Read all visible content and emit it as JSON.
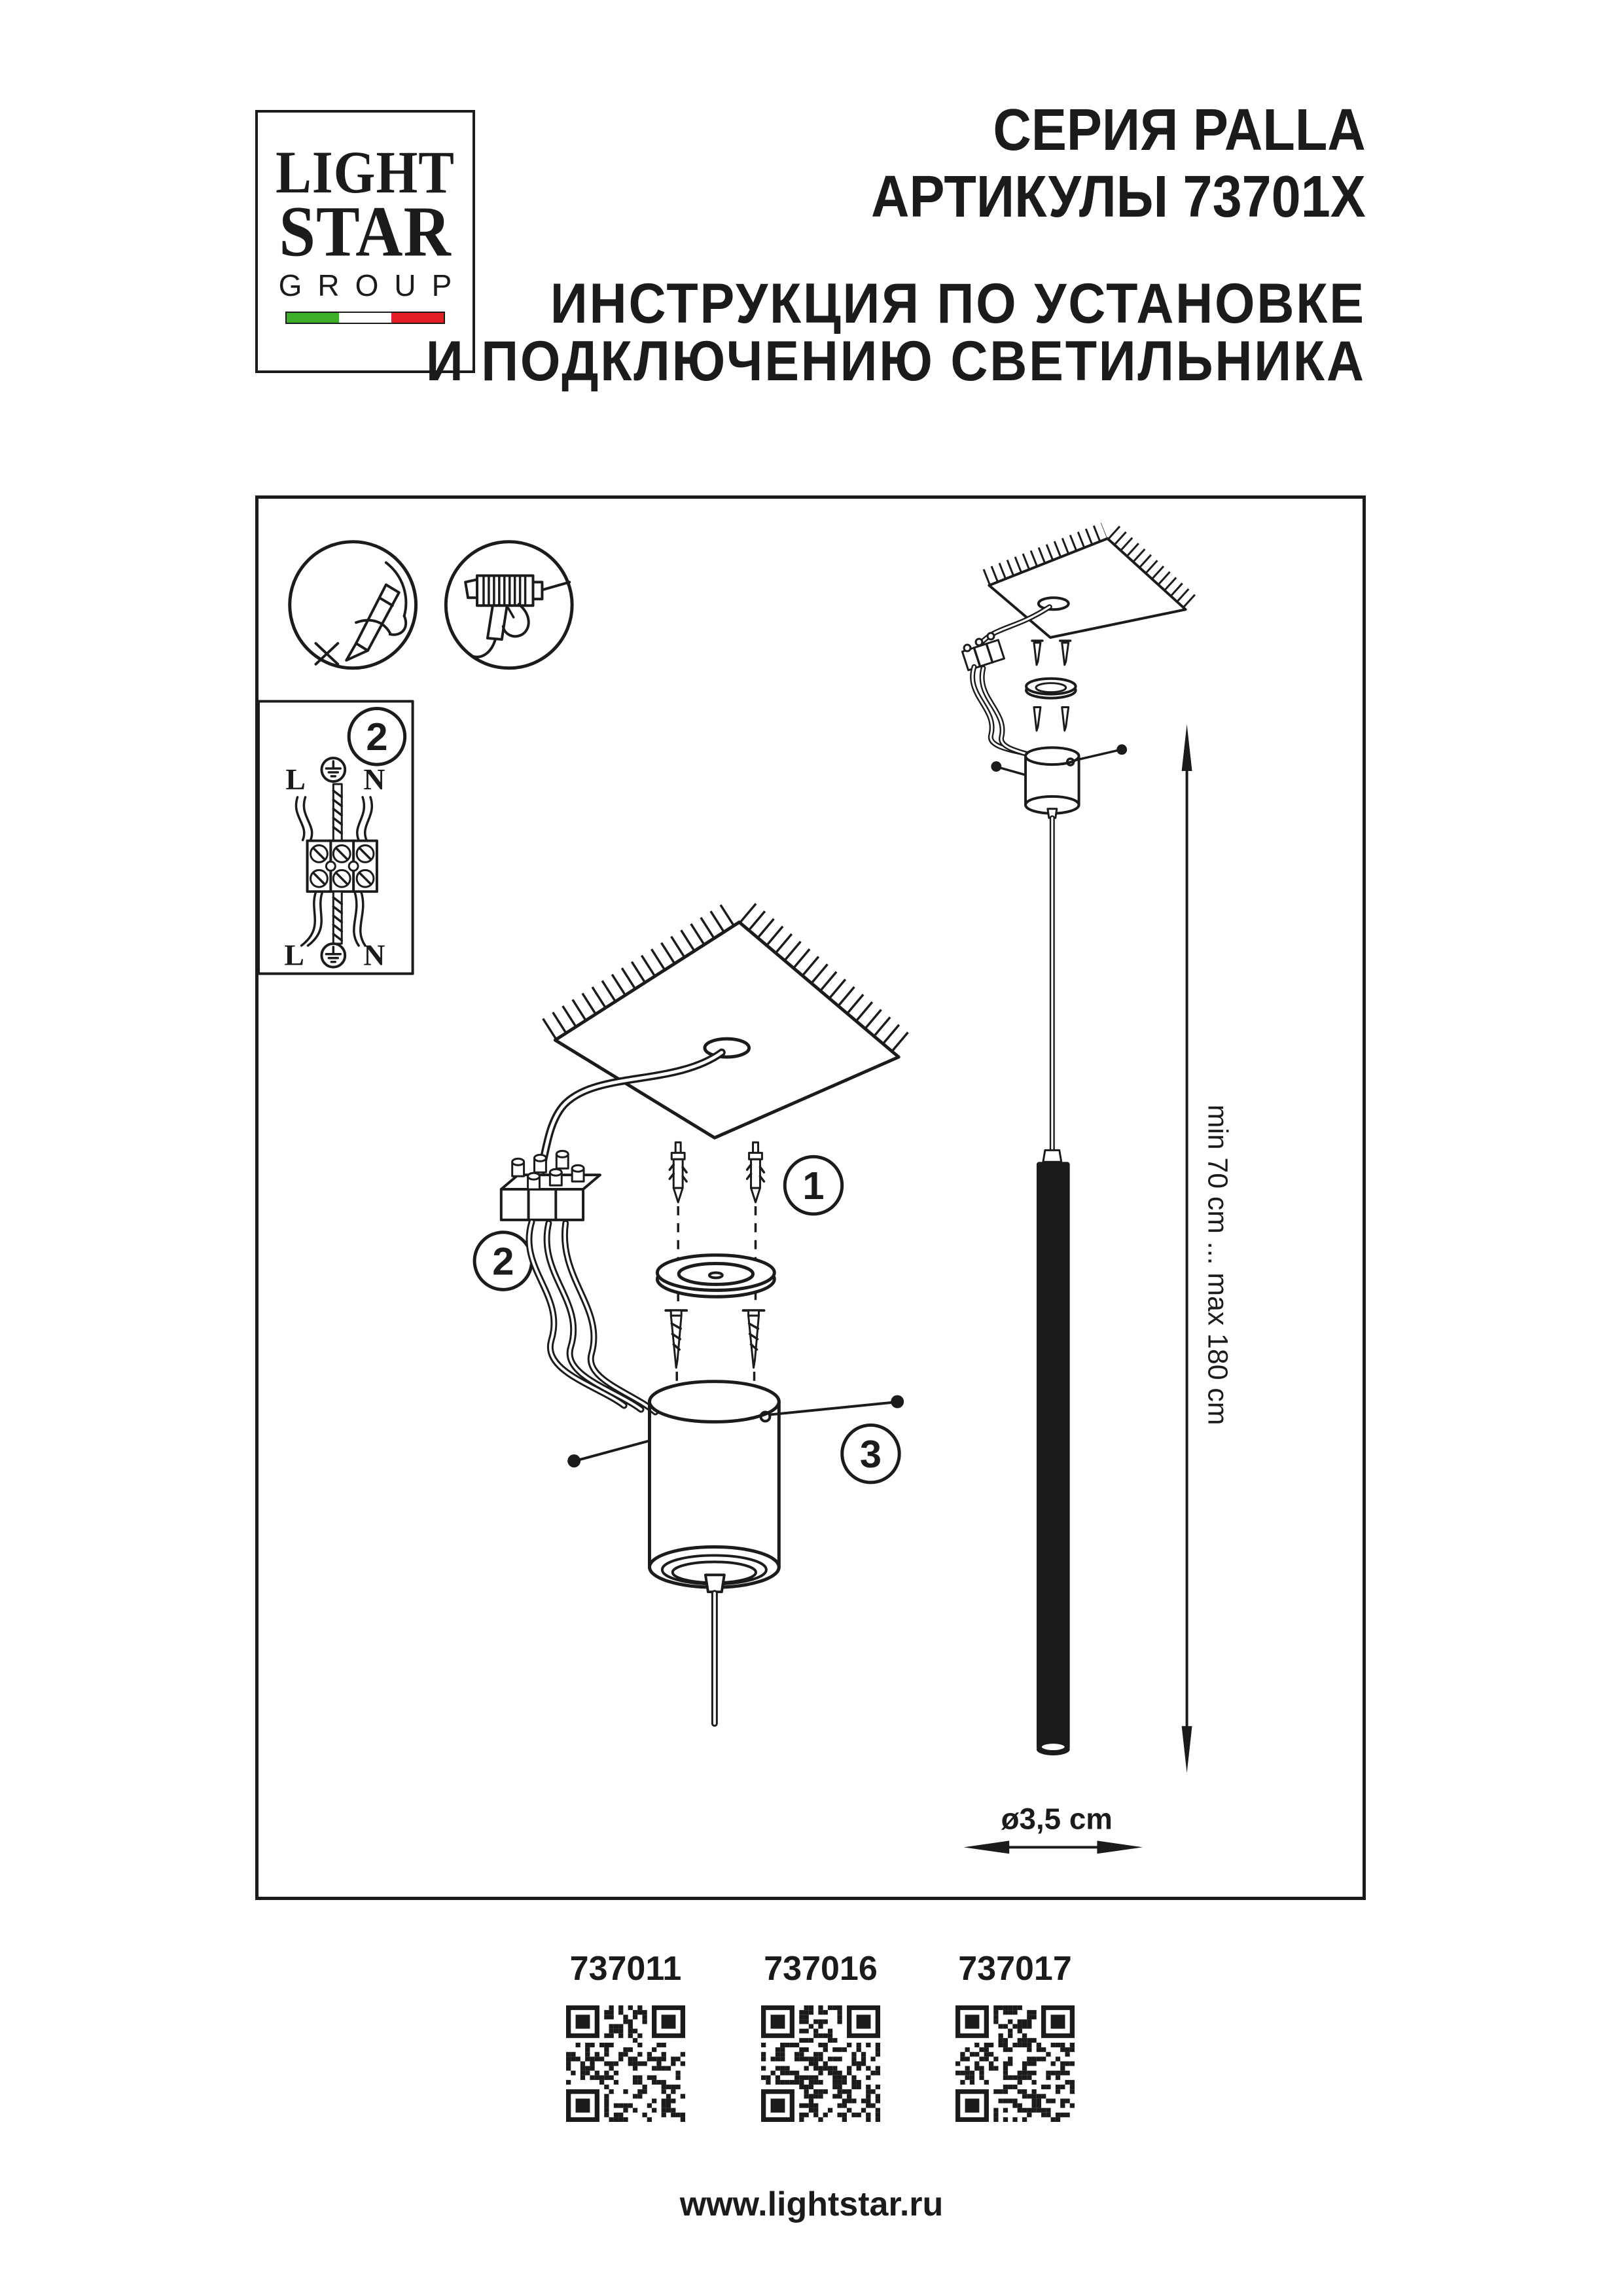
{
  "logo": {
    "line1": "LIGHT",
    "line2": "STAR",
    "line3": "GROUP"
  },
  "header": {
    "series": "СЕРИЯ PALLA",
    "articles": "АРТИКУЛЫ 73701X",
    "instruction_line1": "ИНСТРУКЦИЯ ПО УСТАНОВКЕ",
    "instruction_line2": "И ПОДКЛЮЧЕНИЮ СВЕТИЛЬНИКА"
  },
  "wiring_diagram": {
    "step": "2",
    "top_left": "L",
    "top_right": "N",
    "bottom_left": "L",
    "bottom_right": "N"
  },
  "steps": {
    "anchors": "1",
    "wiring": "2",
    "canopy": "3"
  },
  "dimensions": {
    "height_range": "min 70 cm ... max 180 cm",
    "diameter": "ø3,5 cm"
  },
  "qr_section": {
    "items": [
      {
        "label": "737011"
      },
      {
        "label": "737016"
      },
      {
        "label": "737017"
      }
    ]
  },
  "footer": {
    "website": "www.lightstar.ru"
  },
  "colors": {
    "ink": "#1b1b1b",
    "flag_green": "#3fae29",
    "flag_white": "#ffffff",
    "flag_red": "#e31e24"
  }
}
